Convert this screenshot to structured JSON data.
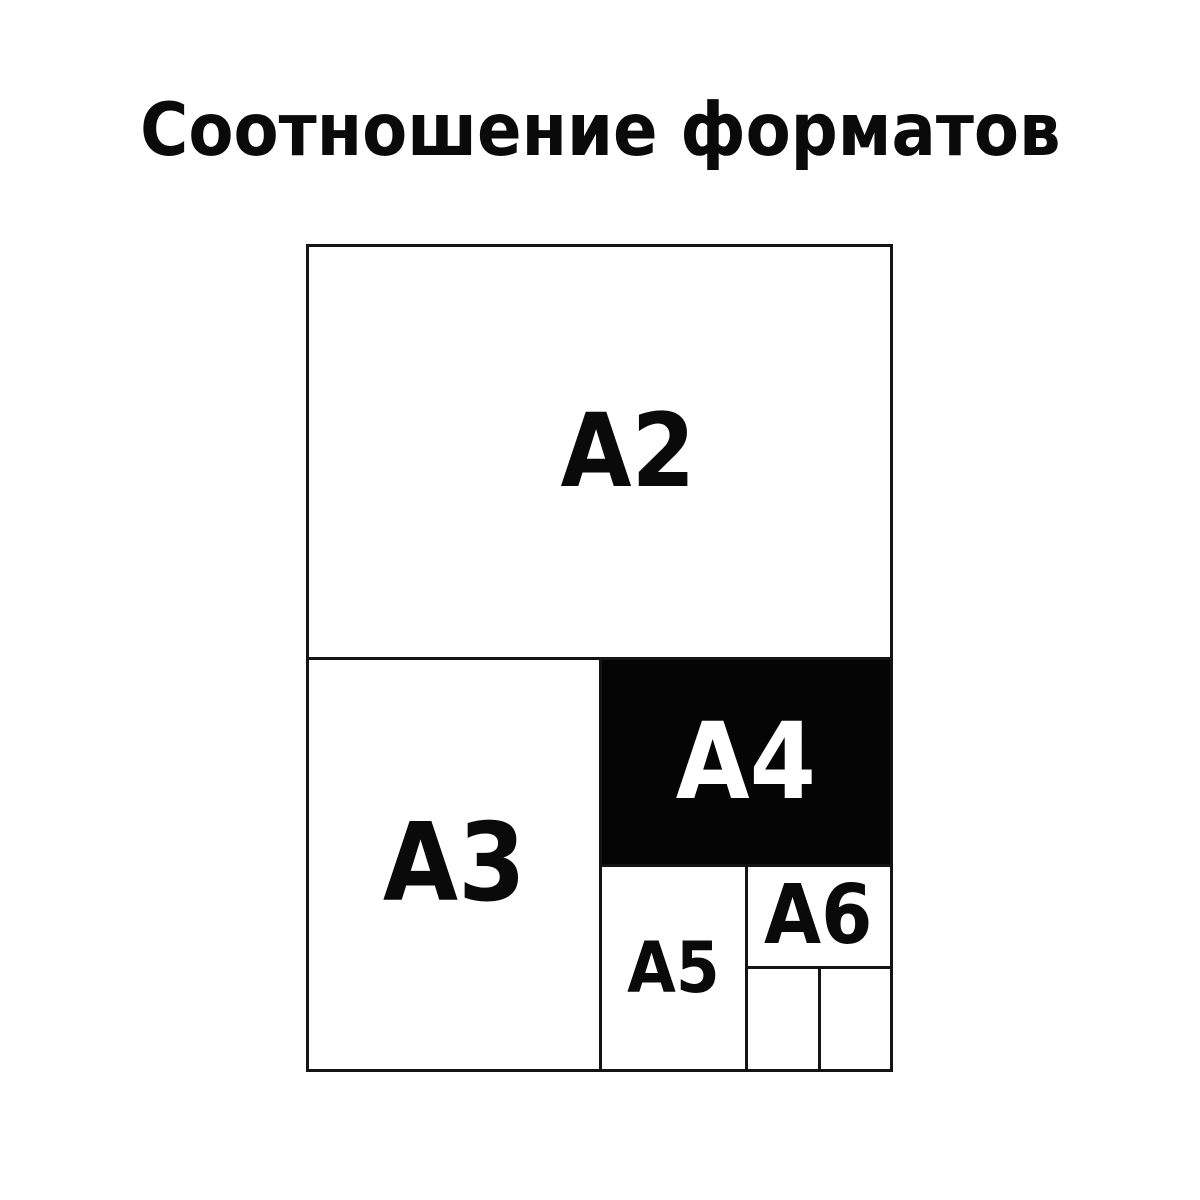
{
  "title": "Соотношение форматов",
  "colors": {
    "background": "#ffffff",
    "line": "#141414",
    "text": "#0a0a0a",
    "a4fill": "#050505",
    "a4text": "#ffffff"
  },
  "diagram": {
    "formats": {
      "a2": {
        "label": "A2"
      },
      "a3": {
        "label": "A3"
      },
      "a4": {
        "label": "A4"
      },
      "a5": {
        "label": "A5"
      },
      "a6": {
        "label": "A6"
      }
    }
  }
}
